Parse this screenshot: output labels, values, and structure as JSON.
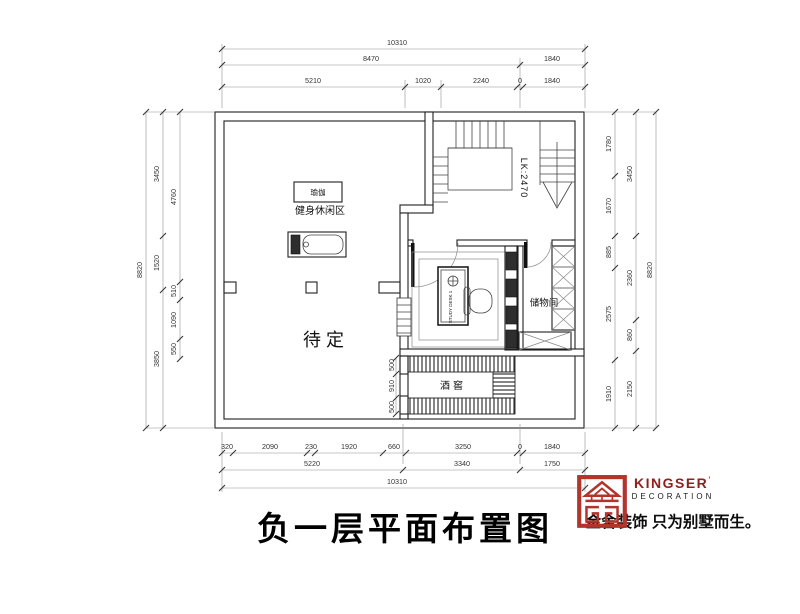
{
  "title": "负一层平面布置图",
  "plan": {
    "rooms": {
      "yoga": "瑜伽",
      "fitness_area": "健身休闲区",
      "pending": "待定",
      "wine_cellar": "酒窖",
      "storage": "储物间",
      "stair_label": "LK:2470",
      "desk_label": "STUDY DESK 1"
    },
    "dimensions": {
      "top": [
        {
          "v": "10310",
          "x": 397,
          "y": 45
        },
        {
          "v": "8470",
          "x": 371,
          "y": 61
        },
        {
          "v": "1840",
          "x": 552,
          "y": 61
        },
        {
          "v": "5210",
          "x": 313,
          "y": 83
        },
        {
          "v": "1020",
          "x": 423,
          "y": 83
        },
        {
          "v": "2240",
          "x": 481,
          "y": 83
        },
        {
          "v": "0",
          "x": 520,
          "y": 83
        },
        {
          "v": "1840",
          "x": 552,
          "y": 83
        }
      ],
      "bottom": [
        {
          "v": "320",
          "x": 227,
          "y": 449
        },
        {
          "v": "2090",
          "x": 270,
          "y": 449
        },
        {
          "v": "230",
          "x": 311,
          "y": 449
        },
        {
          "v": "1920",
          "x": 349,
          "y": 449
        },
        {
          "v": "660",
          "x": 394,
          "y": 449
        },
        {
          "v": "3250",
          "x": 463,
          "y": 449
        },
        {
          "v": "0",
          "x": 520,
          "y": 449
        },
        {
          "v": "1840",
          "x": 552,
          "y": 449
        },
        {
          "v": "5220",
          "x": 312,
          "y": 466
        },
        {
          "v": "3340",
          "x": 462,
          "y": 466
        },
        {
          "v": "1750",
          "x": 552,
          "y": 466
        },
        {
          "v": "10310",
          "x": 397,
          "y": 484
        }
      ],
      "left": [
        {
          "v": "8820",
          "x": 142,
          "y": 270,
          "rot": true
        },
        {
          "v": "3450",
          "x": 159,
          "y": 174,
          "rot": true
        },
        {
          "v": "1520",
          "x": 159,
          "y": 263,
          "rot": true
        },
        {
          "v": "3850",
          "x": 159,
          "y": 359,
          "rot": true
        },
        {
          "v": "4760",
          "x": 176,
          "y": 197,
          "rot": true
        },
        {
          "v": "510",
          "x": 176,
          "y": 291,
          "rot": true
        },
        {
          "v": "1090",
          "x": 176,
          "y": 320,
          "rot": true
        },
        {
          "v": "550",
          "x": 176,
          "y": 349,
          "rot": true
        }
      ],
      "right": [
        {
          "v": "1780",
          "x": 611,
          "y": 144,
          "rot": true
        },
        {
          "v": "1670",
          "x": 611,
          "y": 206,
          "rot": true
        },
        {
          "v": "885",
          "x": 611,
          "y": 252,
          "rot": true
        },
        {
          "v": "2575",
          "x": 611,
          "y": 314,
          "rot": true
        },
        {
          "v": "1910",
          "x": 611,
          "y": 394,
          "rot": true
        },
        {
          "v": "3450",
          "x": 632,
          "y": 174,
          "rot": true
        },
        {
          "v": "2360",
          "x": 632,
          "y": 278,
          "rot": true
        },
        {
          "v": "860",
          "x": 632,
          "y": 335,
          "rot": true
        },
        {
          "v": "2150",
          "x": 632,
          "y": 389,
          "rot": true
        },
        {
          "v": "8820",
          "x": 652,
          "y": 270,
          "rot": true
        }
      ],
      "wine": [
        {
          "v": "500",
          "x": 394,
          "y": 365,
          "rot": true
        },
        {
          "v": "910",
          "x": 394,
          "y": 386,
          "rot": true
        },
        {
          "v": "500",
          "x": 394,
          "y": 407,
          "rot": true
        }
      ]
    }
  },
  "branding": {
    "logo_name": "KINGSER",
    "logo_mark": "’",
    "logo_subtitle": "DECORATION",
    "tagline": "金舍装饰 只为别墅而生。",
    "logo_color": "#b2342c"
  }
}
